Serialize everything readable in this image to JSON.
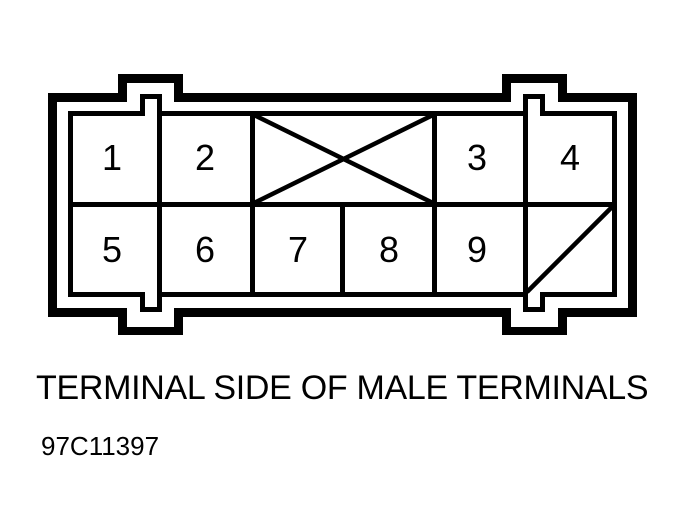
{
  "diagram": {
    "caption": "TERMINAL SIDE OF MALE TERMINALS",
    "figure_id": "97C11397",
    "colors": {
      "line": "#000000",
      "background": "#ffffff"
    },
    "connector": {
      "view": "terminal side",
      "terminal_gender": "male",
      "rows": [
        {
          "cells": [
            {
              "type": "pin",
              "label": "1"
            },
            {
              "type": "pin",
              "label": "2"
            },
            {
              "type": "blocked",
              "label": "",
              "marking": "x-cross"
            },
            {
              "type": "pin",
              "label": "3"
            },
            {
              "type": "pin",
              "label": "4"
            }
          ]
        },
        {
          "cells": [
            {
              "type": "pin",
              "label": "5"
            },
            {
              "type": "pin",
              "label": "6"
            },
            {
              "type": "pin",
              "label": "7"
            },
            {
              "type": "pin",
              "label": "8"
            },
            {
              "type": "pin",
              "label": "9"
            },
            {
              "type": "keyed",
              "label": "",
              "marking": "diagonal-slash"
            }
          ]
        }
      ]
    }
  }
}
